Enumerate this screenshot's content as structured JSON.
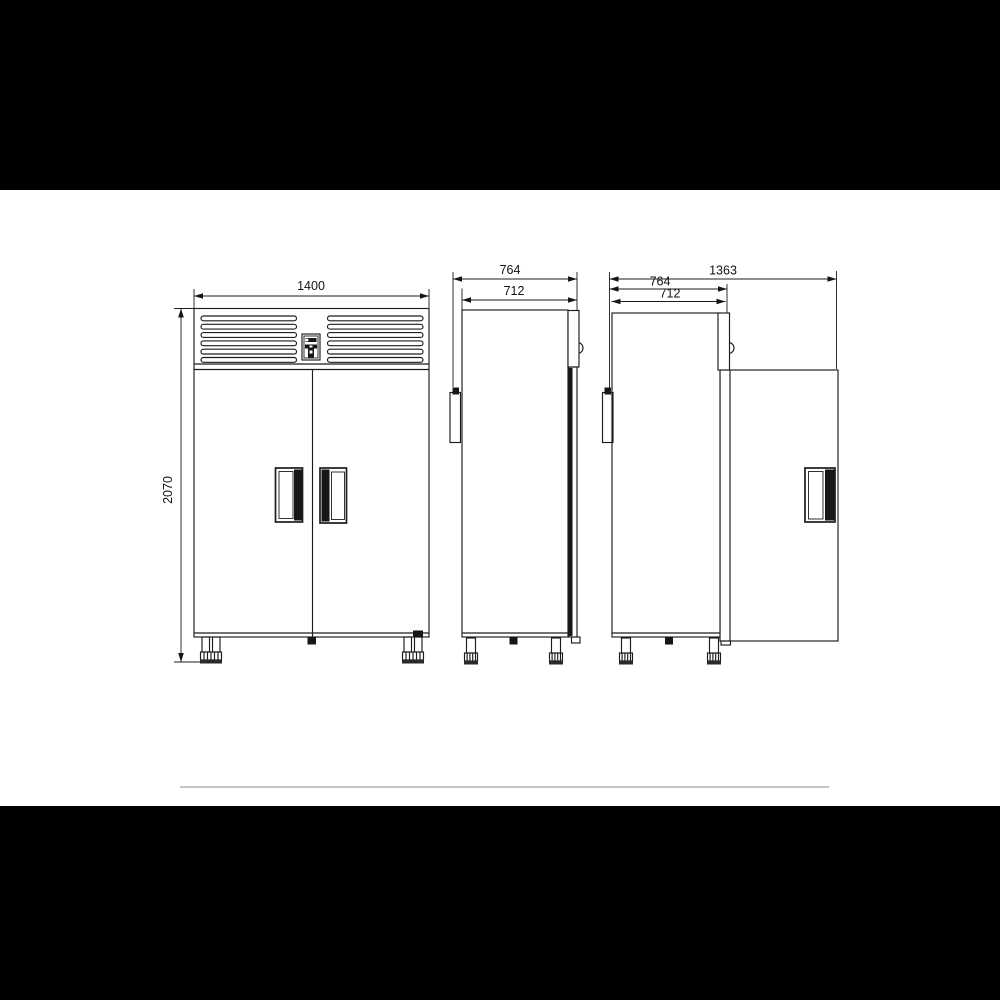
{
  "drawing": {
    "front_view": {
      "width_mm": "1400",
      "height_mm": "2070"
    },
    "side_view_closed": {
      "overall_depth_mm": "764",
      "body_depth_mm": "712"
    },
    "side_view_open": {
      "overall_open_mm": "1363",
      "overall_depth_mm": "764",
      "body_depth_mm": "712"
    }
  },
  "colors": {
    "letterbox": "#000000",
    "canvas": "#ffffff",
    "line": "#1c1c1c",
    "divider": "#c6c6c6"
  }
}
